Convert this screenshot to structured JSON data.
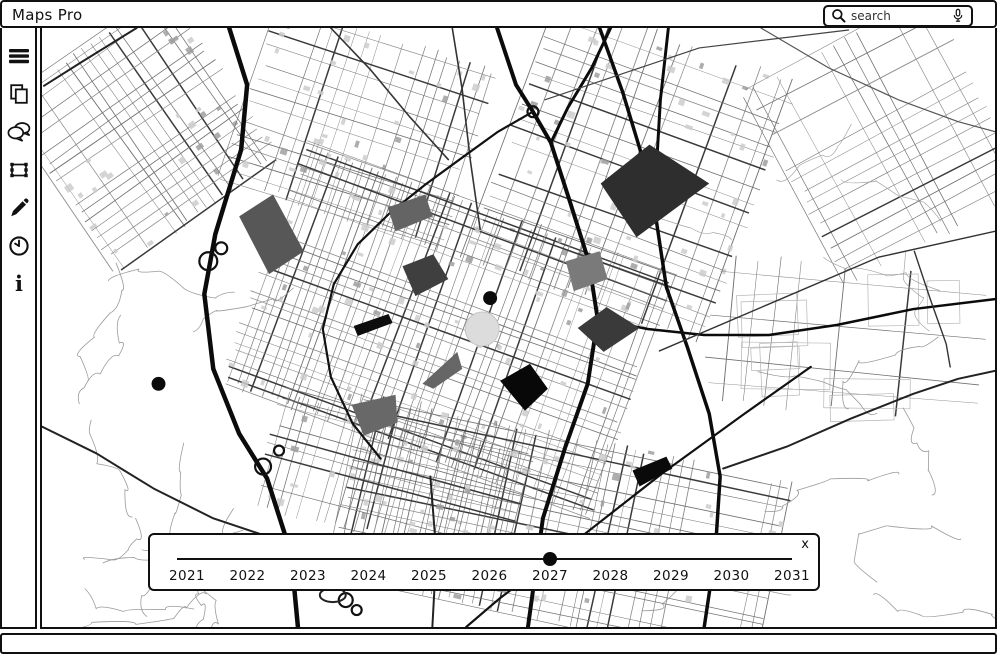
{
  "app": {
    "title": "Maps Pro"
  },
  "search": {
    "placeholder": "search",
    "icons": [
      "magnifier-icon",
      "microphone-icon"
    ]
  },
  "sidebar": {
    "items": [
      {
        "id": "menu",
        "icon": "hamburger-icon"
      },
      {
        "id": "layers",
        "icon": "pages-icon"
      },
      {
        "id": "comments",
        "icon": "chat-icon"
      },
      {
        "id": "select",
        "icon": "transform-icon"
      },
      {
        "id": "draw",
        "icon": "pencil-icon"
      },
      {
        "id": "history",
        "icon": "clock-icon"
      },
      {
        "id": "info",
        "icon": "info-icon"
      }
    ]
  },
  "timeline": {
    "years": [
      "2021",
      "2022",
      "2023",
      "2024",
      "2025",
      "2026",
      "2027",
      "2028",
      "2029",
      "2030",
      "2031"
    ],
    "selected_year": "2027",
    "close_label": "x"
  },
  "map": {
    "overlay_polygons": [
      {
        "points": [
          [
            238,
            217
          ],
          [
            272,
            195
          ],
          [
            303,
            252
          ],
          [
            268,
            275
          ]
        ],
        "color": "#575757"
      },
      {
        "points": [
          [
            387,
            208
          ],
          [
            425,
            195
          ],
          [
            432,
            217
          ],
          [
            395,
            232
          ]
        ],
        "color": "#646464"
      },
      {
        "points": [
          [
            650,
            145
          ],
          [
            710,
            184
          ],
          [
            637,
            238
          ],
          [
            601,
            184
          ]
        ],
        "color": "#2e2e2e"
      },
      {
        "points": [
          [
            402,
            267
          ],
          [
            433,
            255
          ],
          [
            448,
            280
          ],
          [
            415,
            297
          ]
        ],
        "color": "#3f3f3f"
      },
      {
        "points": [
          [
            566,
            262
          ],
          [
            600,
            252
          ],
          [
            608,
            280
          ],
          [
            574,
            292
          ]
        ],
        "color": "#7a7a7a"
      },
      {
        "points": [
          [
            353,
            327
          ],
          [
            388,
            315
          ],
          [
            392,
            324
          ],
          [
            357,
            337
          ]
        ],
        "color": "#0d0d0d"
      },
      {
        "points": [
          [
            607,
            308
          ],
          [
            640,
            329
          ],
          [
            604,
            353
          ],
          [
            578,
            329
          ]
        ],
        "color": "#3a3a3a"
      },
      {
        "points": [
          [
            457,
            353
          ],
          [
            462,
            370
          ],
          [
            433,
            390
          ],
          [
            422,
            385
          ]
        ],
        "color": "#666666"
      },
      {
        "points": [
          [
            530,
            365
          ],
          [
            548,
            390
          ],
          [
            525,
            412
          ],
          [
            500,
            382
          ]
        ],
        "color": "#080808"
      },
      {
        "points": [
          [
            351,
            406
          ],
          [
            395,
            396
          ],
          [
            397,
            424
          ],
          [
            363,
            437
          ]
        ],
        "color": "#686868"
      },
      {
        "points": [
          [
            633,
            472
          ],
          [
            667,
            458
          ],
          [
            673,
            470
          ],
          [
            640,
            488
          ]
        ],
        "color": "#0a0a0a"
      }
    ],
    "dots": [
      {
        "x": 490,
        "y": 299,
        "r": 7
      },
      {
        "x": 157,
        "y": 385,
        "r": 7
      }
    ],
    "highlight_circle": {
      "x": 482,
      "y": 330,
      "r": 17,
      "color": "#dcdcdc"
    }
  },
  "colors": {
    "ink": "#101010",
    "map_street": "#8d8d8d",
    "map_major": "#0b0b0b"
  }
}
